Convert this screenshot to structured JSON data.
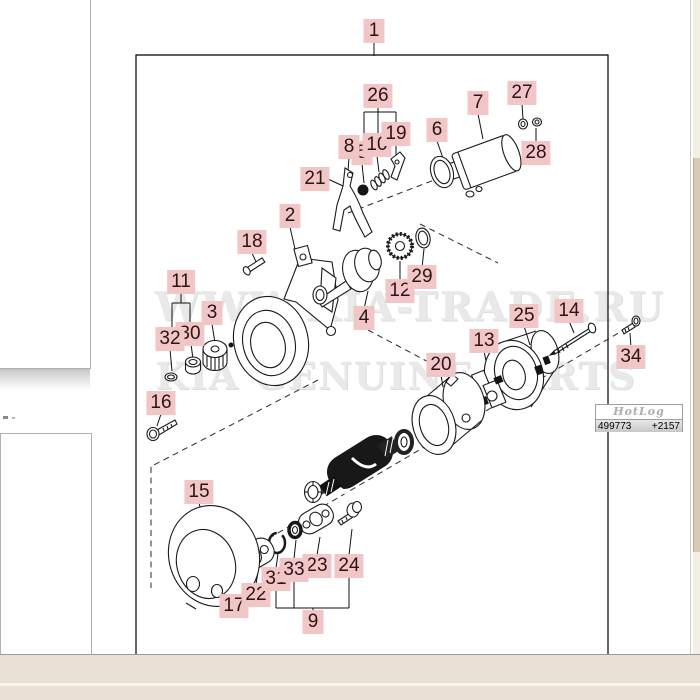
{
  "watermark": {
    "line1": "WWW.KIA-TRADE.RU",
    "line2": "KIA GENUINE PARTS"
  },
  "hotlog": {
    "logo": "HotLog",
    "visits": "499773",
    "today": "+2157"
  },
  "colors": {
    "label_bg": "#f2c6c6",
    "label_text": "#2b1414",
    "line_art": "#1a1a1a",
    "watermark": "#e9e9e9",
    "bottom_strip": "#e9e1d6",
    "scroll_thumb": "#d8cbb6"
  },
  "diagram": {
    "labels": [
      {
        "id": "1",
        "x": 374,
        "y": 31
      },
      {
        "id": "2",
        "x": 290,
        "y": 216
      },
      {
        "id": "3",
        "x": 212,
        "y": 313
      },
      {
        "id": "4",
        "x": 364,
        "y": 318
      },
      {
        "id": "5",
        "x": 362,
        "y": 153
      },
      {
        "id": "6",
        "x": 437,
        "y": 130
      },
      {
        "id": "7",
        "x": 478,
        "y": 103
      },
      {
        "id": "8",
        "x": 349,
        "y": 147
      },
      {
        "id": "9",
        "x": 313,
        "y": 622
      },
      {
        "id": "10",
        "x": 377,
        "y": 145
      },
      {
        "id": "11",
        "x": 181,
        "y": 282
      },
      {
        "id": "12",
        "x": 400,
        "y": 291
      },
      {
        "id": "13",
        "x": 484,
        "y": 341
      },
      {
        "id": "14",
        "x": 569,
        "y": 311
      },
      {
        "id": "15",
        "x": 199,
        "y": 492
      },
      {
        "id": "16",
        "x": 161,
        "y": 403
      },
      {
        "id": "17",
        "x": 234,
        "y": 606
      },
      {
        "id": "18",
        "x": 252,
        "y": 242
      },
      {
        "id": "19",
        "x": 396,
        "y": 134
      },
      {
        "id": "20",
        "x": 441,
        "y": 365
      },
      {
        "id": "21",
        "x": 315,
        "y": 179
      },
      {
        "id": "22",
        "x": 256,
        "y": 595
      },
      {
        "id": "23",
        "x": 317,
        "y": 566
      },
      {
        "id": "24",
        "x": 349,
        "y": 566
      },
      {
        "id": "25",
        "x": 524,
        "y": 316
      },
      {
        "id": "26",
        "x": 378,
        "y": 96
      },
      {
        "id": "27",
        "x": 522,
        "y": 93
      },
      {
        "id": "28",
        "x": 536,
        "y": 153
      },
      {
        "id": "29",
        "x": 422,
        "y": 277
      },
      {
        "id": "30",
        "x": 190,
        "y": 334
      },
      {
        "id": "31",
        "x": 276,
        "y": 579
      },
      {
        "id": "32",
        "x": 170,
        "y": 339
      },
      {
        "id": "33",
        "x": 294,
        "y": 570
      },
      {
        "id": "34",
        "x": 631,
        "y": 357
      }
    ]
  }
}
